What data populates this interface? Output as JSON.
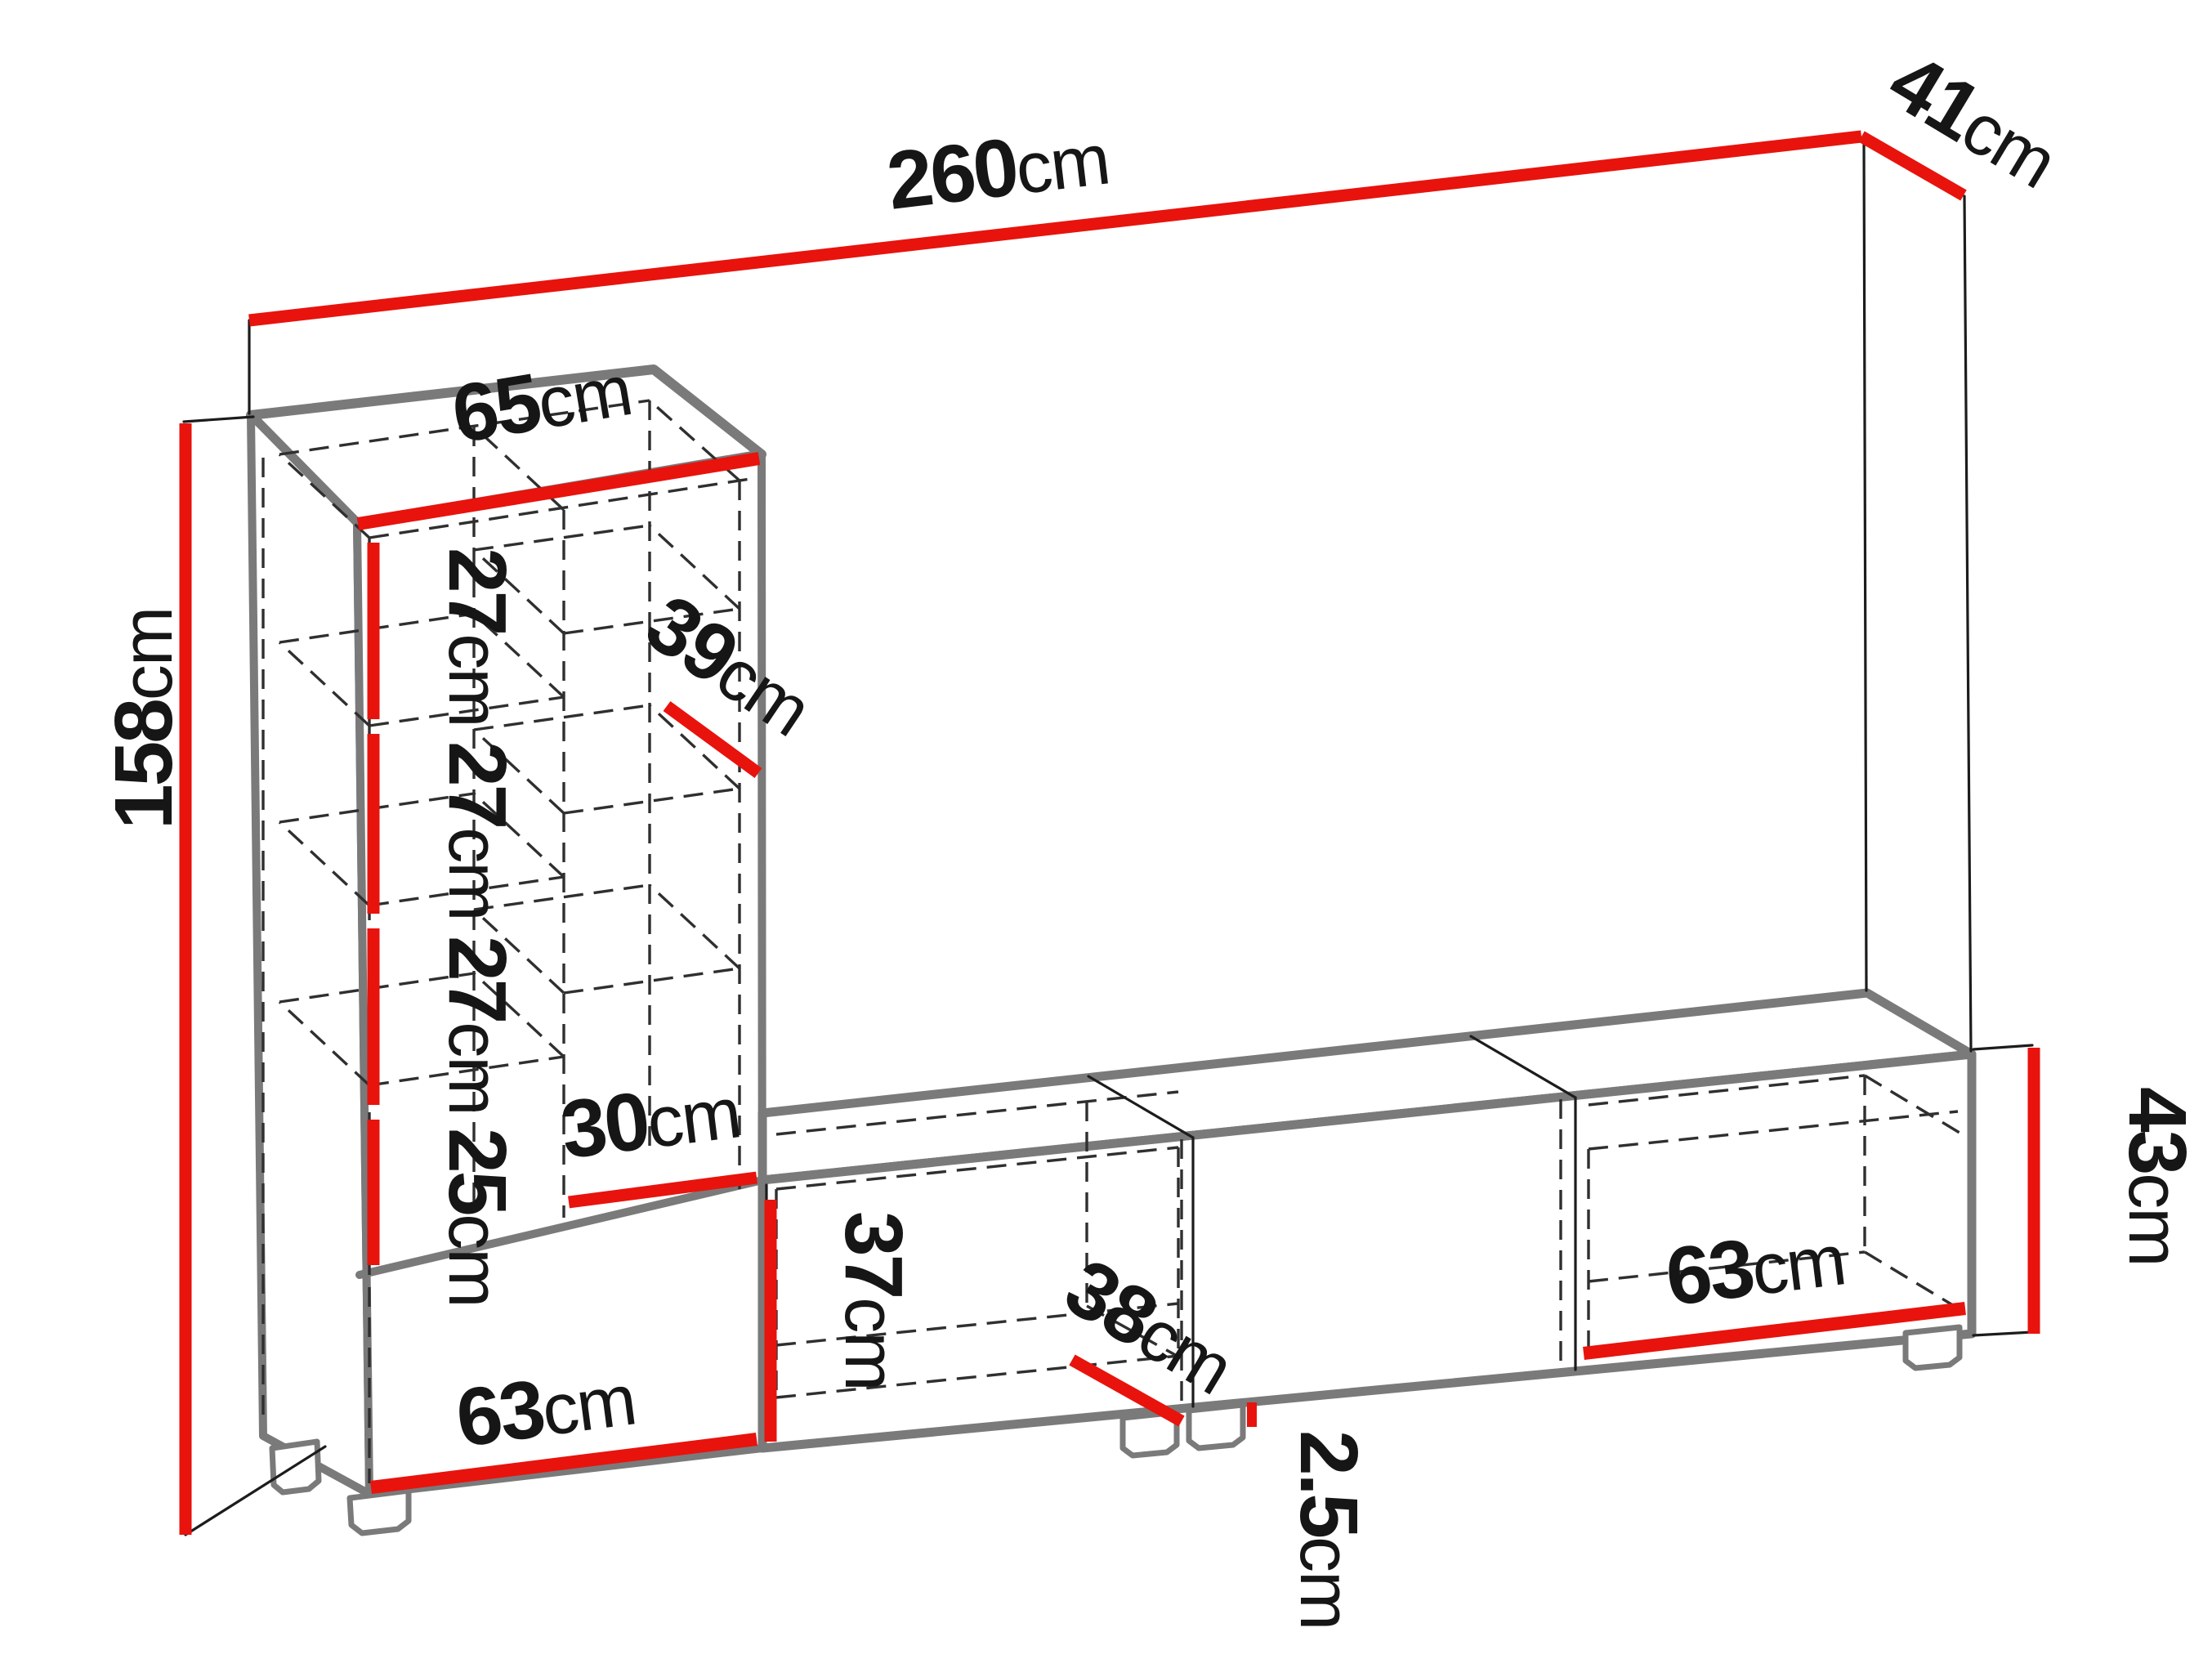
{
  "diagram": {
    "title": "wall-unit-dimension-diagram",
    "subject": "Wall unit: tall open shelf cabinet on base cabinet (left) with long low TV bench (right), isometric line drawing with red dimension lines",
    "unit_system": "cm",
    "colors": {
      "dimension": "#e8130d",
      "structure": "#7a7a7a",
      "hidden": "#2f2f2f",
      "edge": "#1c1c1c",
      "text": "#161616",
      "bg": "#ffffff"
    },
    "dims": {
      "total_width": {
        "value": "260",
        "unit": "cm"
      },
      "right_depth": {
        "value": "41",
        "unit": "cm"
      },
      "cabinet_width": {
        "value": "65",
        "unit": "cm"
      },
      "cabinet_height": {
        "value": "158",
        "unit": "cm"
      },
      "shelf_gap_1": {
        "value": "27",
        "unit": "cm"
      },
      "shelf_gap_2": {
        "value": "27",
        "unit": "cm"
      },
      "shelf_gap_3": {
        "value": "27",
        "unit": "cm"
      },
      "shelf_gap_4": {
        "value": "25",
        "unit": "cm"
      },
      "shelf_depth": {
        "value": "39",
        "unit": "cm"
      },
      "niche_width": {
        "value": "30",
        "unit": "cm"
      },
      "bench_inner_height": {
        "value": "37",
        "unit": "cm"
      },
      "bench_inner_depth": {
        "value": "38",
        "unit": "cm"
      },
      "plinth_height": {
        "value": "2.5",
        "unit": "cm"
      },
      "base_width_left": {
        "value": "63",
        "unit": "cm"
      },
      "base_width_right": {
        "value": "63",
        "unit": "cm"
      },
      "bench_height": {
        "value": "43",
        "unit": "cm"
      }
    }
  }
}
